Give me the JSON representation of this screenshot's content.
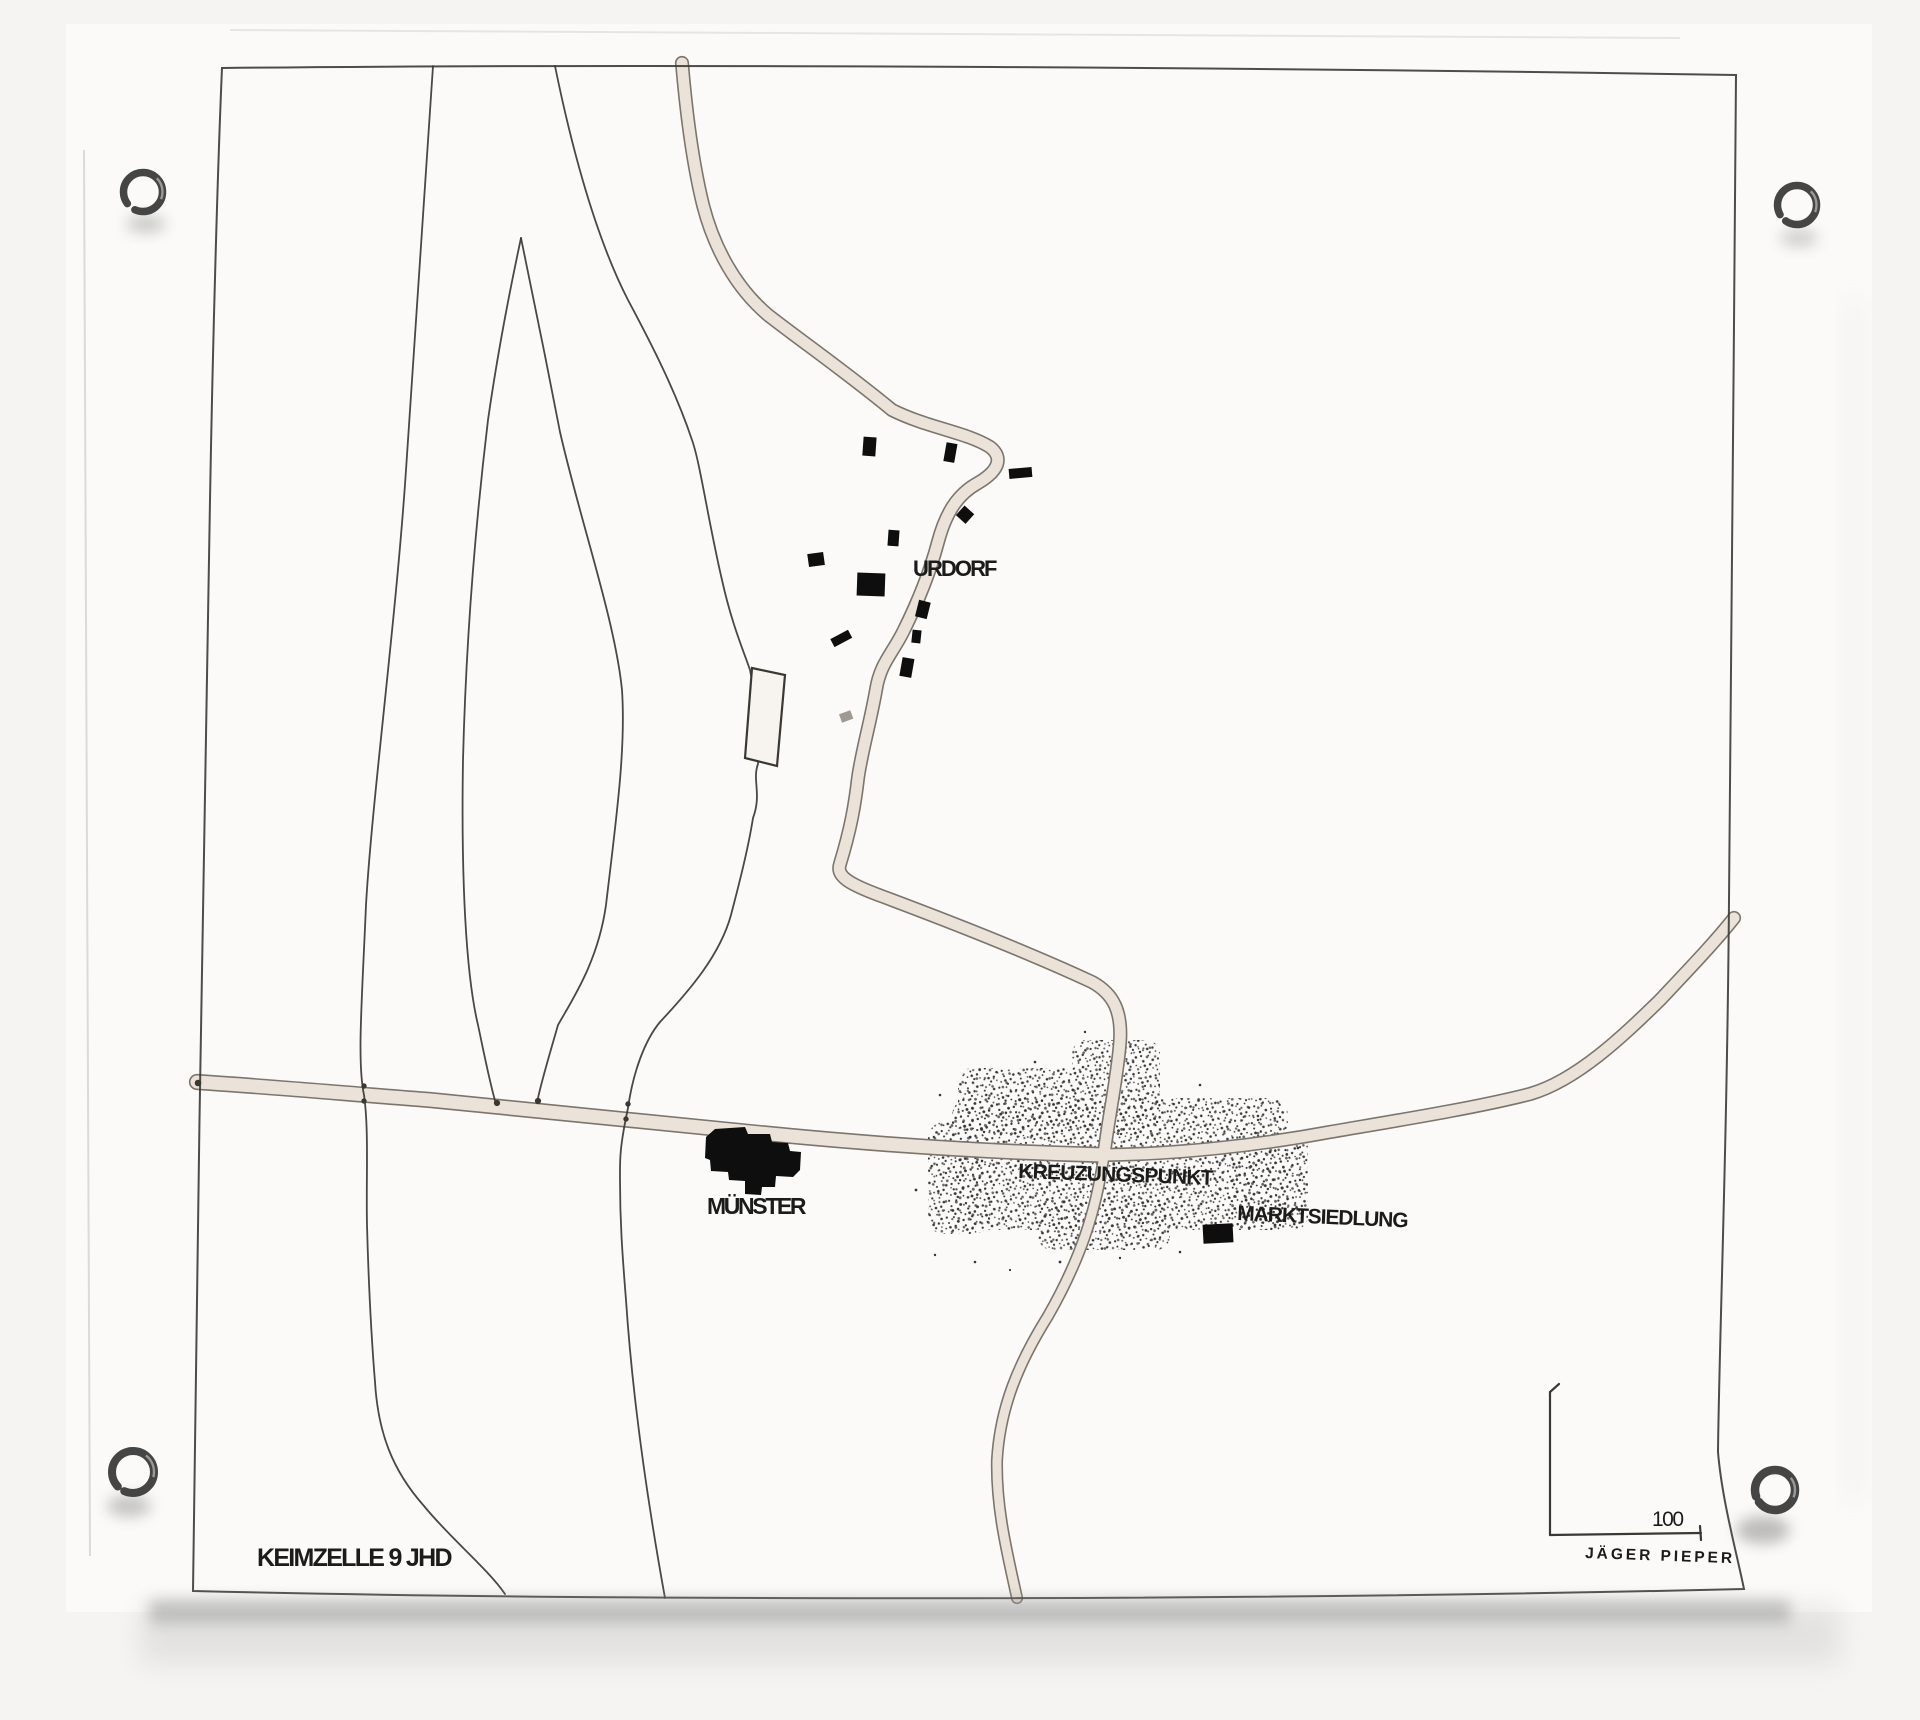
{
  "colors": {
    "ink": "#3a3833",
    "ink_black": "#0e0e0e",
    "label_ink": "#1b1b1b",
    "road_edge": "#7b756d",
    "road_fill": "#ebe3d9",
    "stipple": "#2c2c2c",
    "ring_metal": "#454545",
    "paper": "#fbfaf8"
  },
  "map": {
    "labels": {
      "village": "URDORF",
      "minster": "MÜNSTER",
      "crossing": "KREUZUNGSPUNKT",
      "market_settlement": "MARKTSIEDLUNG"
    },
    "caption": "KEIMZELLE 9 JHD",
    "scale": {
      "value": "100"
    },
    "credit": "JÄGER PIEPER"
  }
}
